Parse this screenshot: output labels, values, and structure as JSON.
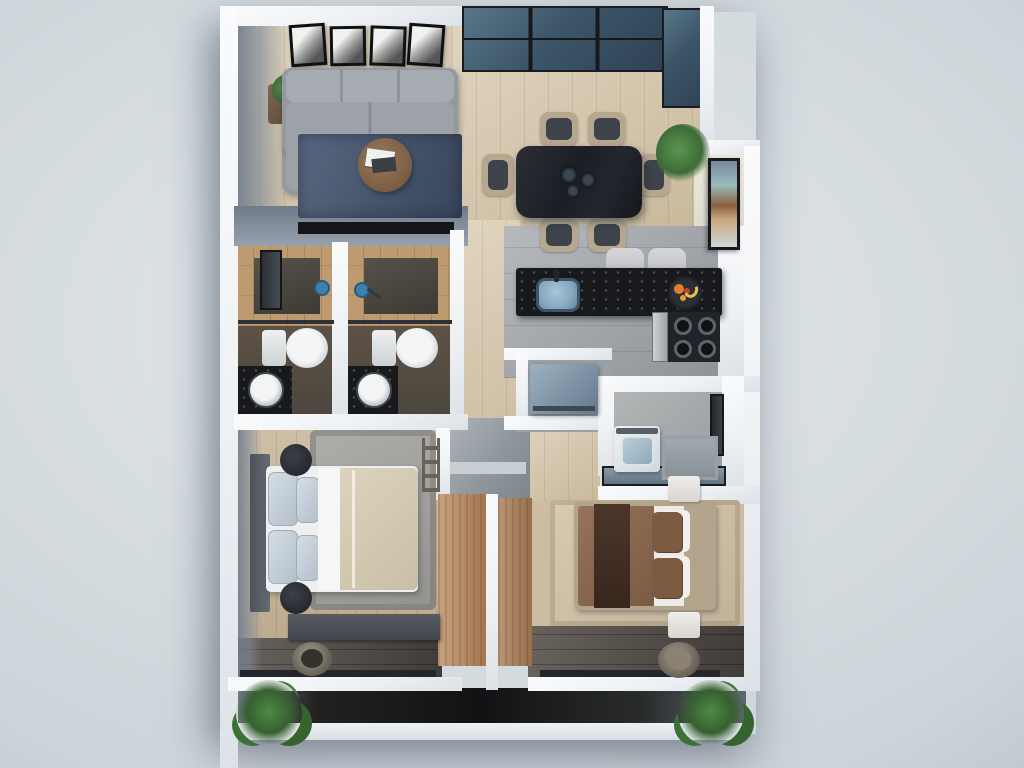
{
  "scene": {
    "title": "Top-down 3D render of a two-bedroom apartment floor plan",
    "style": "photorealistic architectural visualization, no text labels",
    "view": "top-down orthographic",
    "background": {
      "corner": "#b6c0c9",
      "center": "#e3e8ec"
    }
  },
  "palette": {
    "wall_white": "#f3f5f7",
    "wall_face_blue_gray": "#7e8b99",
    "floor_tile_beige": "#d6c7ab",
    "floor_tile_gray": "#a6aaaf",
    "floor_wood_light": "#c6b296",
    "floor_wood_dark": "#57504a",
    "balcony_floor": "#17161a",
    "window_glass": "#3c5568",
    "counter_stone_black": "#17191d",
    "sofa_gray": "#94989f",
    "rug_navy": "#4d5a73",
    "rug_gray": "#a2a19e",
    "rug_tan": "#cfc0a7",
    "duvet_beige": "#d5cbb4",
    "duvet_brown": "#8a684f",
    "wood_door": "#bb8d63",
    "appliance_blue_gray": "#7d93a5",
    "plant_green": "#3e6b38"
  },
  "rooms": {
    "living": {
      "label": "Living room",
      "furniture": [
        "L-shaped gray sofa",
        "round wood coffee table with books",
        "dark side table with plant",
        "navy area rug",
        "four framed wall pictures",
        "wall-mounted TV"
      ]
    },
    "dining": {
      "label": "Dining area",
      "furniture": [
        "black marble dining table",
        "six upholstered chairs",
        "three-plate centerpiece",
        "corner potted plant",
        "framed wall art",
        "corner glazing"
      ]
    },
    "kitchen": {
      "label": "Kitchen",
      "furniture": [
        "black stone breakfast bar",
        "blue undermount sink",
        "two bar stools",
        "fruit bowl",
        "gas cooktop with silver oven",
        "blue-gray refrigerator"
      ]
    },
    "bath1": {
      "label": "Bathroom 1",
      "furniture": [
        "wood-tiled shower",
        "toilet",
        "round vessel sink on dark vanity",
        "tall window"
      ]
    },
    "bath2": {
      "label": "Bathroom 2",
      "furniture": [
        "wood-tiled shower",
        "toilet",
        "round vessel sink on dark vanity"
      ]
    },
    "laundry": {
      "label": "Laundry room",
      "furniture": [
        "top-load washing machine",
        "gray shelving counter",
        "side window"
      ]
    },
    "hall": {
      "label": "Hallway",
      "furniture": [
        "beige plank tile",
        "gray vestibule landing"
      ]
    },
    "master": {
      "label": "Main bedroom",
      "furniture": [
        "double bed with beige duvet",
        "dark headboard",
        "two round black nightstands",
        "gray rug",
        "dark dresser",
        "blanket ladder",
        "round planter",
        "wooden wardrobe"
      ]
    },
    "bedroom2": {
      "label": "Second bedroom",
      "furniture": [
        "double bed with brown duvet and dark throw",
        "two white nightstands",
        "tan rug",
        "wooden wardrobe",
        "round planter"
      ]
    },
    "balcony": {
      "label": "Balcony",
      "furniture": [
        "dark deck strip",
        "two green grass plants"
      ]
    }
  }
}
